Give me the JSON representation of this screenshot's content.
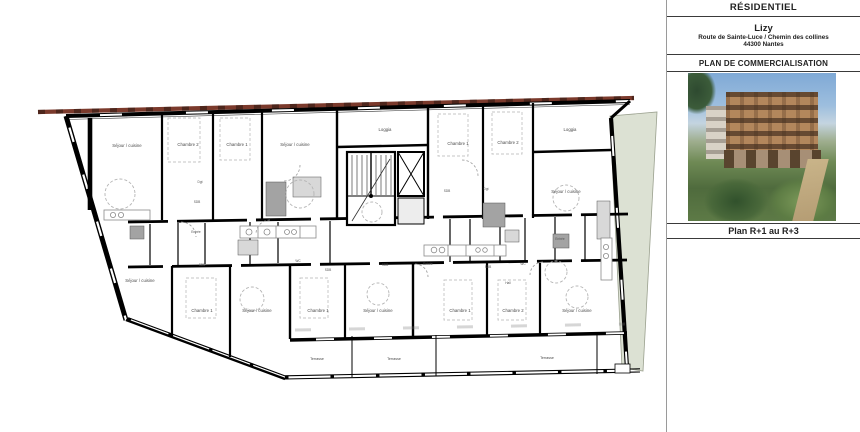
{
  "panel": {
    "header": "RÉSIDENTIEL",
    "project_name": "Lizy",
    "address_line1": "Route de Sainte-Luce / Chemin des collines",
    "address_line2": "44300 Nantes",
    "doc_title": "PLAN DE COMMERCIALISATION",
    "photo_caption": "Plan R+1 au R+3",
    "photo_alt": "perspective-render-of-residence"
  },
  "plan": {
    "floor_range": "R+1 au R+3",
    "colors": {
      "facade_red": "#7b3a2c",
      "landscape_green": "#dce1d3",
      "duct_dark_gray": "#a3a3a3",
      "duct_light_gray": "#d8d8d8"
    },
    "rooms": [
      {
        "label": "Séjour / cuisine",
        "x": 127,
        "y": 147
      },
      {
        "label": "Chambre 2",
        "x": 188,
        "y": 146
      },
      {
        "label": "Chambre 1",
        "x": 237,
        "y": 146
      },
      {
        "label": "Séjour / cuisine",
        "x": 295,
        "y": 146
      },
      {
        "label": "Chambre 1",
        "x": 458,
        "y": 145
      },
      {
        "label": "Chambre 2",
        "x": 508,
        "y": 144
      },
      {
        "label": "Séjour / cuisine",
        "x": 566,
        "y": 193
      },
      {
        "label": "Séjour / cuisine",
        "x": 140,
        "y": 282
      },
      {
        "label": "Chambre 1",
        "x": 202,
        "y": 312
      },
      {
        "label": "Séjour / cuisine",
        "x": 257,
        "y": 312
      },
      {
        "label": "Chambre 1",
        "x": 318,
        "y": 312
      },
      {
        "label": "Séjour / cuisine",
        "x": 378,
        "y": 312
      },
      {
        "label": "Chambre 1",
        "x": 460,
        "y": 312
      },
      {
        "label": "Chambre 2",
        "x": 513,
        "y": 312
      },
      {
        "label": "Séjour / cuisine",
        "x": 577,
        "y": 312
      }
    ],
    "loggias": [
      {
        "label": "Loggia",
        "x": 385,
        "y": 131
      },
      {
        "label": "Loggia",
        "x": 570,
        "y": 131
      }
    ],
    "small_rooms": [
      {
        "label": "Dgt",
        "x": 200,
        "y": 183
      },
      {
        "label": "SDB",
        "x": 197,
        "y": 203
      },
      {
        "label": "SDB",
        "x": 447,
        "y": 192
      },
      {
        "label": "Dgt",
        "x": 486,
        "y": 190
      },
      {
        "label": "Entrée",
        "x": 196,
        "y": 233
      },
      {
        "label": "SDB",
        "x": 202,
        "y": 266
      },
      {
        "label": "WC",
        "x": 298,
        "y": 262
      },
      {
        "label": "SDB",
        "x": 328,
        "y": 271
      },
      {
        "label": "SDB",
        "x": 385,
        "y": 266
      },
      {
        "label": "Entrée",
        "x": 428,
        "y": 265
      },
      {
        "label": "SDB",
        "x": 488,
        "y": 268
      },
      {
        "label": "WC",
        "x": 523,
        "y": 265
      },
      {
        "label": "Hall",
        "x": 508,
        "y": 284
      },
      {
        "label": "Entrée",
        "x": 560,
        "y": 240
      }
    ],
    "terraces": [
      {
        "label": "Terrasse",
        "x": 317,
        "y": 360
      },
      {
        "label": "Terrasse",
        "x": 394,
        "y": 360
      },
      {
        "label": "Terrasse",
        "x": 547,
        "y": 359
      }
    ]
  }
}
